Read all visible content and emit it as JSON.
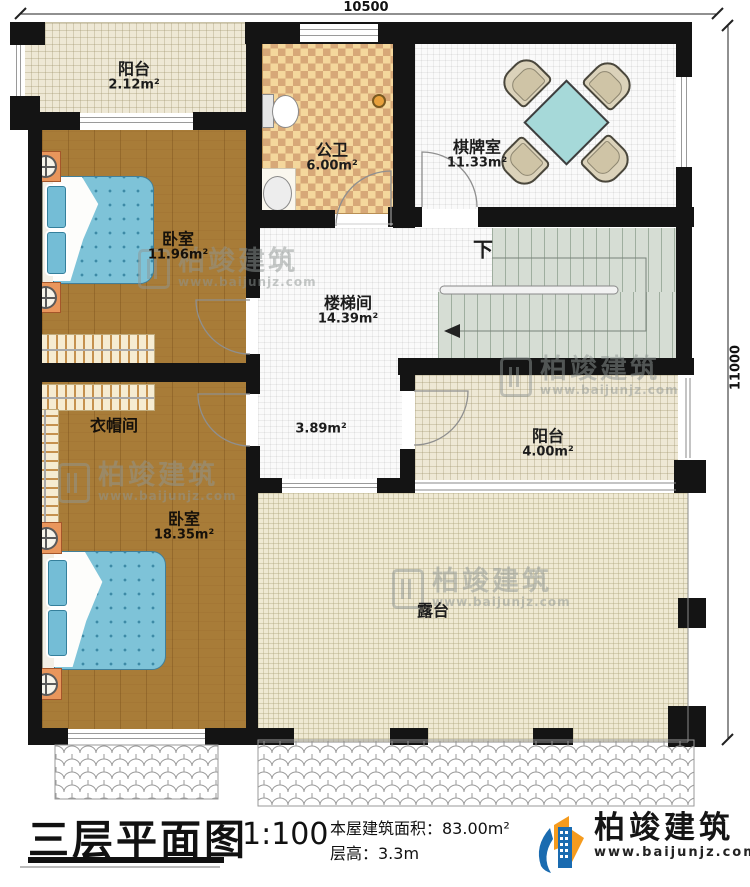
{
  "dims": {
    "top": "10500",
    "right": "11000"
  },
  "rooms": {
    "balcony_top": {
      "name": "阳台",
      "area": "2.12m²"
    },
    "bedroom1": {
      "name": "卧室",
      "area": "11.96m²"
    },
    "bathroom": {
      "name": "公卫",
      "area": "6.00m²"
    },
    "chess": {
      "name": "棋牌室",
      "area": "11.33m²"
    },
    "stairwell": {
      "name": "楼梯间",
      "area": "14.39m²"
    },
    "hall": {
      "area": "3.89m²"
    },
    "cloakroom": {
      "name": "衣帽间"
    },
    "bedroom2": {
      "name": "卧室",
      "area": "18.35m²"
    },
    "balcony_right": {
      "name": "阳台",
      "area": "4.00m²"
    },
    "terrace": {
      "name": "露台"
    }
  },
  "stairs": {
    "down": "下"
  },
  "titleblock": {
    "title": "三层平面图",
    "scale": "1:100",
    "area_line": "本屋建筑面积：83.00m²",
    "height_line": "层高：3.3m"
  },
  "brand": {
    "name": "柏竣建筑",
    "site": "www.baijunjz.com"
  },
  "watermark": {
    "name": "柏竣建筑",
    "site": "www.baijunjz.com"
  },
  "colors": {
    "wall": "#141414",
    "wood": "#a87c38",
    "mattress": "#7ec3d8",
    "tile_light": "#f4d79c",
    "tile_dark": "#d7a878",
    "stair": "#d6ddd4",
    "brand_blue": "#1a6bb0",
    "brand_orange": "#f59b1e"
  }
}
